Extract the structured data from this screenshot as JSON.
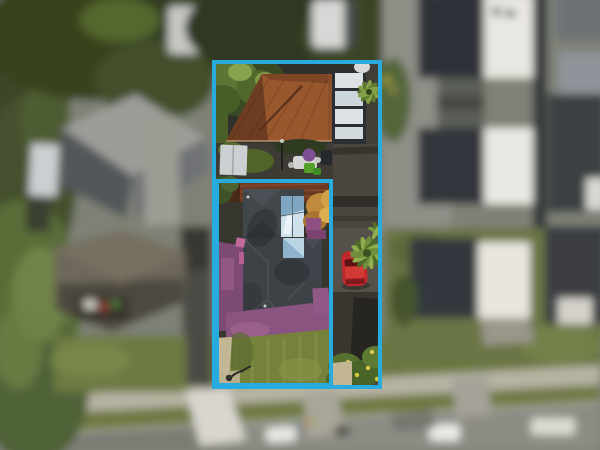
{
  "image": {
    "kind": "aerial-drone-photo",
    "width": 600,
    "height": 450,
    "description": "Top-down aerial photo of a suburban property. The subject property is sharp and outlined with cyan lot-boundary lines (an outer full-parcel rectangle and an inner front-lot rectangle); all surroundings are blurred."
  },
  "overlay": {
    "boundary_color": "#28abdf",
    "stroke_width": 4,
    "lots": [
      {
        "name": "full-parcel-boundary"
      },
      {
        "name": "front-lot-boundary"
      }
    ]
  },
  "palette": {
    "boundary": "#28abdf",
    "blur_base": "#7e8176",
    "road": "#8c8c85",
    "road_dark": "#7c7b74",
    "footpath": "#b7b2a3",
    "grass_verge": "#6e7942",
    "lawn": "#75823c",
    "lawn_light": "#8a9a48",
    "path_beige": "#c3b795",
    "tree_dark": "#3c4827",
    "tree_light": "#7e9448",
    "terracotta": "#98572d",
    "terracotta_dark": "#6e3c21",
    "pergola_panel": "#dde2e6",
    "house_roof": "#3d4247",
    "house_roof_light": "#4b5056",
    "glass_reflection": "#cfe2ec",
    "glass_blue": "#7fa6c2",
    "purple_paving": "#7c4a74",
    "purple_paving_bottom": "#8a5480",
    "asphalt": "#4a463e",
    "red_car": "#c1272d",
    "gray_car_roof": "#a8acae",
    "white_car": "#e9e9e4",
    "shed_white": "#cbd0d2",
    "palm_green": "#6f8f3a",
    "palm_light": "#8fae4d",
    "flower_yellow": "#d9c944",
    "townhouse_dark": "#2e3337",
    "townhouse_white": "#e9e7e1",
    "neighbor_roof_gray": "#9c9d99",
    "neighbor_roof_brown": "#6e675b",
    "umbrella_purple": "#7b4f92"
  },
  "features": {
    "outlined_property": {
      "rear_building": "terracotta tile hip roof (garage / granny flat)",
      "carport": "white translucent pergola panels",
      "main_house": "dark slate-gray hip roof with reflective glass / skylight section",
      "ground": "purple painted paving wrapping house, green front lawn, beige path",
      "vehicles": [
        "red car on side driveway",
        "gray car in rear yard"
      ],
      "vegetation": [
        "leafy tree rear-left",
        "palm fronds",
        "golden tree",
        "flowering shrubs with yellow blooms"
      ]
    },
    "surroundings": {
      "left": "blurred neighbor houses with gray and brown hip roofs, dense trees",
      "right": "blurred townhouses with alternating charcoal and white roofs",
      "bottom": "blurred street with footpath, grass verge, parked white cars"
    }
  }
}
